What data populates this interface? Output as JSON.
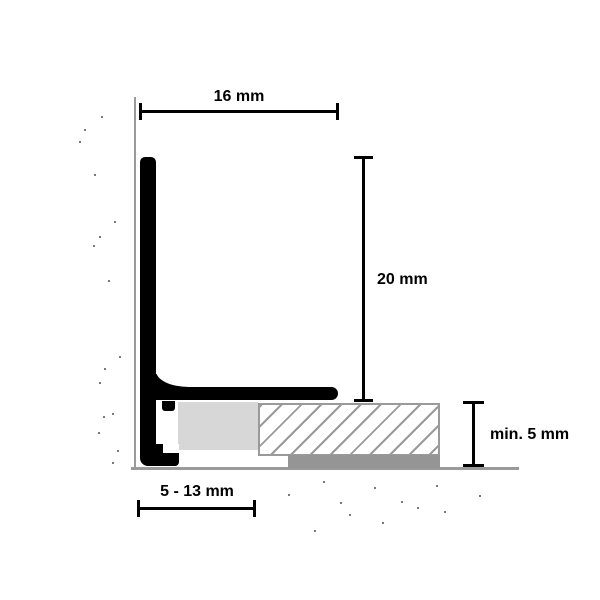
{
  "diagram": {
    "dimensions": {
      "top": "16 mm",
      "right": "20 mm",
      "depth": "min. 5 mm",
      "bottom": "5 - 13 mm"
    },
    "colors": {
      "profile_black": "#000000",
      "wall_floor_line_gray": "#9a9a9a",
      "profile_base_gray": "#d7d7d7",
      "adhesive_gray": "#959595",
      "hatch_gray": "#9a9a9a",
      "speckle_gray": "#4f4f4f",
      "background": "#ffffff"
    },
    "speckles": {
      "wall": [
        [
          101,
          116
        ],
        [
          84,
          129
        ],
        [
          79,
          141
        ],
        [
          94,
          174
        ],
        [
          114,
          221
        ],
        [
          99,
          236
        ],
        [
          93,
          245
        ],
        [
          108,
          280
        ],
        [
          119,
          356
        ],
        [
          104,
          368
        ],
        [
          99,
          382
        ],
        [
          112,
          413
        ],
        [
          103,
          416
        ],
        [
          98,
          432
        ],
        [
          117,
          450
        ],
        [
          112,
          462
        ]
      ],
      "floor": [
        [
          323,
          481
        ],
        [
          374,
          487
        ],
        [
          436,
          485
        ],
        [
          288,
          494
        ],
        [
          479,
          495
        ],
        [
          340,
          502
        ],
        [
          401,
          501
        ],
        [
          417,
          507
        ],
        [
          444,
          511
        ],
        [
          349,
          514
        ],
        [
          382,
          522
        ],
        [
          314,
          530
        ]
      ]
    }
  }
}
